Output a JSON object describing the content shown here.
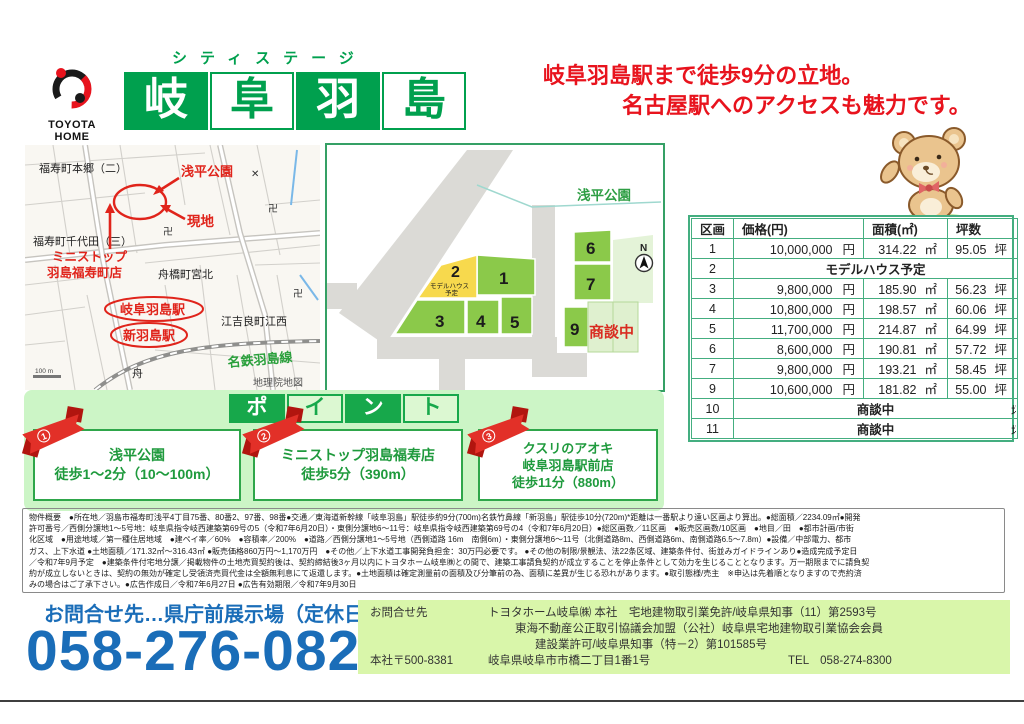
{
  "brand": {
    "logo_line1": "TOYOTA",
    "logo_line2": "HOME"
  },
  "header": {
    "subtitle": "シティステージ",
    "title_chars": [
      "岐",
      "阜",
      "羽",
      "島"
    ],
    "catch_line1": "岐阜羽島駅まで徒歩9分の立地。",
    "catch_line2": "名古屋駅へのアクセスも魅力です。"
  },
  "colors": {
    "brand_green": "#00a04e",
    "accent_red": "#e8131d",
    "table_border_green": "#44ae80",
    "point_band_green": "#ccf5c6",
    "footer_blue": "#1a6db8",
    "company_box_green": "#d9f6aa",
    "lot_green": "#8bc94a",
    "lot_yellow": "#f7d94d"
  },
  "map": {
    "hongo": "福寿町本郷（二）",
    "chiyoda": "福寿町千代田（三）",
    "asahira_park": "浅平公園",
    "genchi": "現地",
    "ministop_line1": "ミニストップ",
    "ministop_line2": "羽島福寿町店",
    "funabashi": "舟橋町宮北",
    "gifu_hashima_sta": "岐阜羽島駅",
    "shin_hashima_sta": "新羽島駅",
    "egira": "江吉良町江西",
    "meitetsu_line": "名鉄羽島線",
    "credit": "地理院地図",
    "scale": "100 m",
    "temple1": "卍",
    "temple2": "卍",
    "temple3": "卍",
    "school_x": "✕",
    "fune": "舟"
  },
  "siteplan": {
    "park": "浅平公園",
    "north": "N",
    "lot_1": "1",
    "lot_2": "2",
    "model_note_l1": "モデルハウス",
    "model_note_l2": "予定",
    "lot_3": "3",
    "lot_4": "4",
    "lot_5": "5",
    "lot_6": "6",
    "lot_7": "7",
    "lot_9": "9",
    "pending": "商談中"
  },
  "table": {
    "headers": [
      "区画",
      "価格(円)",
      "面積(㎡)",
      "坪数"
    ],
    "units": {
      "yen": "円",
      "m2": "㎡",
      "tsubo": "坪"
    },
    "rows": [
      {
        "lot": "1",
        "price": "10,000,000",
        "area": "314.22",
        "tsubo": "95.05"
      },
      {
        "lot": "2",
        "span": "モデルハウス予定"
      },
      {
        "lot": "3",
        "price": "9,800,000",
        "area": "185.90",
        "tsubo": "56.23"
      },
      {
        "lot": "4",
        "price": "10,800,000",
        "area": "198.57",
        "tsubo": "60.06"
      },
      {
        "lot": "5",
        "price": "11,700,000",
        "area": "214.87",
        "tsubo": "64.99"
      },
      {
        "lot": "6",
        "price": "8,600,000",
        "area": "190.81",
        "tsubo": "57.72"
      },
      {
        "lot": "7",
        "price": "9,800,000",
        "area": "193.21",
        "tsubo": "58.45"
      },
      {
        "lot": "9",
        "price": "10,600,000",
        "area": "181.82",
        "tsubo": "55.00"
      },
      {
        "lot": "10",
        "span": "商談中"
      },
      {
        "lot": "11",
        "span": "商談中"
      }
    ]
  },
  "points": {
    "title_chars": [
      "ポ",
      "イ",
      "ン",
      "ト"
    ],
    "items": [
      {
        "badge_number": "1",
        "lines": [
          "浅平公園",
          "徒歩1～2分（10～100m）"
        ]
      },
      {
        "badge_number": "2",
        "lines": [
          "ミニストップ羽島福寿店",
          "徒歩5分（390m）"
        ]
      },
      {
        "badge_number": "3",
        "lines": [
          "クスリのアオキ",
          "岐阜羽島駅前店",
          "徒歩11分（880m）"
        ]
      }
    ]
  },
  "overview": {
    "lines": [
      "物件概要　●所在地／羽島市福寿町浅平4丁目75番、80番2、97番、98番●交通／東海道新幹線「岐阜羽島」駅徒歩約9分(700m)名鉄竹鼻線「新羽島」駅徒歩10分(720m)*距離は一番駅より遠い区画より算出。●総面積／2234.09㎡●開発",
      "許可番号／西側分譲地1～5号地：岐阜県指令岐西建築第69号の5（令和7年6月20日）・東側分譲地6～11号：岐阜県指令岐西建築第69号の4（令和7年6月20日）●総区画数／11区画　●販売区画数/10区画　●地目／田　●都市計画/市街",
      "化区域　●用途地域／第一種住居地域　●建ペイ率／60%　●容積率／200%　●道路／西側分譲地1～5号地（西側道路 16m　南側6m）・東側分譲地6～11号（北側道路8m、西側道路6m、南側道路6.5～7.8m）●設備／中部電力、都市",
      "ガス、上下水道 ●土地面積／171.32㎡～316.43㎡ ●販売価格860万円～1,170万円　●その他／上下水道工事開発負担金：30万円必要です。 ●その他の制限/景観法、法22条区域、建築条件付、街並みガイドラインあり●造成完成予定日",
      "／令和7年9月予定　●建築条件付宅地分譲／掲載物件の土地売買契約後は、契約締結後3ヶ月以内にトヨタホーム岐阜㈱との間で、建築工事請負契約が成立することを停止条件として効力を生じることとなります。万一期限までに請負契",
      "約が成立しないときは、契約の無効が確定し受領済売買代金は全額無利息にて返還します。●土地面積は確定測量前の面積及び分筆前の為、面積に差異が生じる恐れがあります。●取引態様/売主　※申込は先着順となりますので売約済",
      "みの場合はご了承下さい。●広告作成日／令和7年6月27日 ●広告有効期限／令和7年9月30日"
    ]
  },
  "footer": {
    "inquiry_left": "お問合せ先…県庁前展示場（定休日:火・水）",
    "phone": "058-276-0826",
    "company": {
      "label": "お問合せ先",
      "line1": "トヨタホーム岐阜㈱ 本社　宅地建物取引業免許/岐阜県知事（11）第2593号",
      "line2": "東海不動産公正取引協議会加盟（公社）岐阜県宅地建物取引業協会会員",
      "line3": "建設業許可/岐阜県知事（特－2）第101585号",
      "hq_label": "本社〒500-8381",
      "address": "岐阜県岐阜市市橋二丁目1番1号",
      "tel": "TEL　058-274-8300"
    }
  }
}
